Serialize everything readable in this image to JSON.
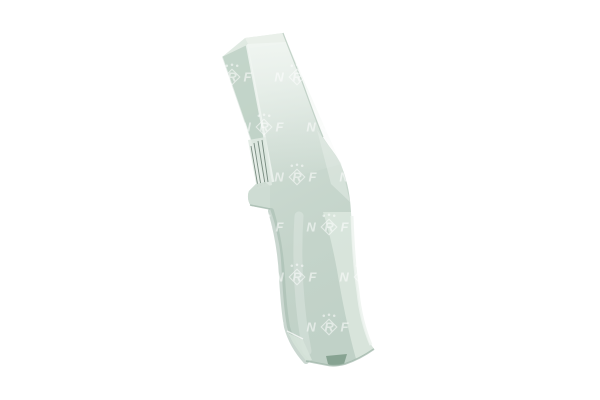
{
  "image": {
    "description": "Product photo of a light mint-green elongated automotive part on a plain white background, covered by a repeating NRF brand watermark",
    "background_color": "#ffffff"
  },
  "watermark": {
    "text": "NRF",
    "letters": [
      "N",
      "R",
      "F"
    ],
    "color": "#ffffff",
    "opacity": 0.55,
    "grid": {
      "y_start": 27,
      "y_spacing": 50,
      "x_spacing": 65,
      "row_bases": [
        264,
        232
      ],
      "rows": 8
    }
  },
  "part": {
    "colors": {
      "top_face": "#eaf0ea",
      "top_tint": "#e2ebe4",
      "main_light": "#ccdad1",
      "main": "#c4d4ca",
      "main_dark": "#c0d1c7",
      "light_face": "#dde8e0",
      "strip_shade": "#bed1c6",
      "fold_highlight": "#f1f6f2",
      "shadow_edge": "#a7bcb0",
      "pale_flange": "#e0eae3",
      "wire_dark": "#5f7468",
      "tab_face": "#cfdcd3",
      "edge_light": "#edf3ee",
      "knee_light": "#e6eee8",
      "bottom_facet": "#d7e3da",
      "dark_accent": "#87a392",
      "outline": "#9db3a6",
      "upper_edge": "#b1c4b8"
    }
  }
}
